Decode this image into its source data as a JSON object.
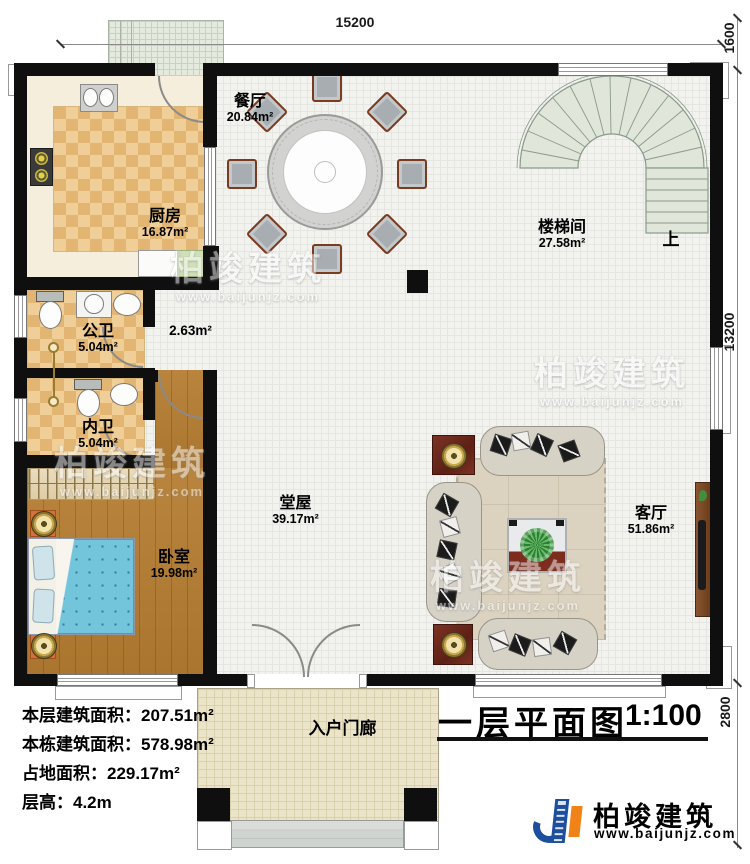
{
  "title": {
    "text": "一层平面图",
    "scale": "1:100"
  },
  "dimensions": {
    "top": "15200",
    "right_top": "1600",
    "right_mid": "13200",
    "right_bottom": "2800"
  },
  "rooms": [
    {
      "name": "餐厅",
      "area": "20.84m²"
    },
    {
      "name": "厨房",
      "area": "16.87m²"
    },
    {
      "name": "楼梯间",
      "area": "27.58m²"
    },
    {
      "name": "公卫",
      "area": "5.04m²"
    },
    {
      "name": "内卫",
      "area": "5.04m²"
    },
    {
      "name": "卧室",
      "area": "19.98m²"
    },
    {
      "name": "堂屋",
      "area": "39.17m²"
    },
    {
      "name": "客厅",
      "area": "51.86m²"
    },
    {
      "name": "入户门廊",
      "area": ""
    }
  ],
  "annotations": {
    "up": "上",
    "small_area": "2.63m²"
  },
  "stats": [
    {
      "label": "本层建筑面积：",
      "value": "207.51m²"
    },
    {
      "label": "本栋建筑面积：",
      "value": "578.98m²"
    },
    {
      "label": "占地面积：",
      "value": "229.17m²"
    },
    {
      "label": "层高：",
      "value": "4.2m"
    }
  ],
  "branding": {
    "company": "柏竣建筑",
    "website": "www.baijunjz.com"
  },
  "colors": {
    "wall": "#0f0f0f",
    "wood": "#b9853e",
    "checker_light": "#efcf97",
    "checker_dark": "#e2b573",
    "stair": "#e0e6da",
    "brand_blue": "#1d4f9e",
    "brand_orange": "#ef8318",
    "bed": "#72c5da",
    "nightstand": "#d4703a"
  }
}
